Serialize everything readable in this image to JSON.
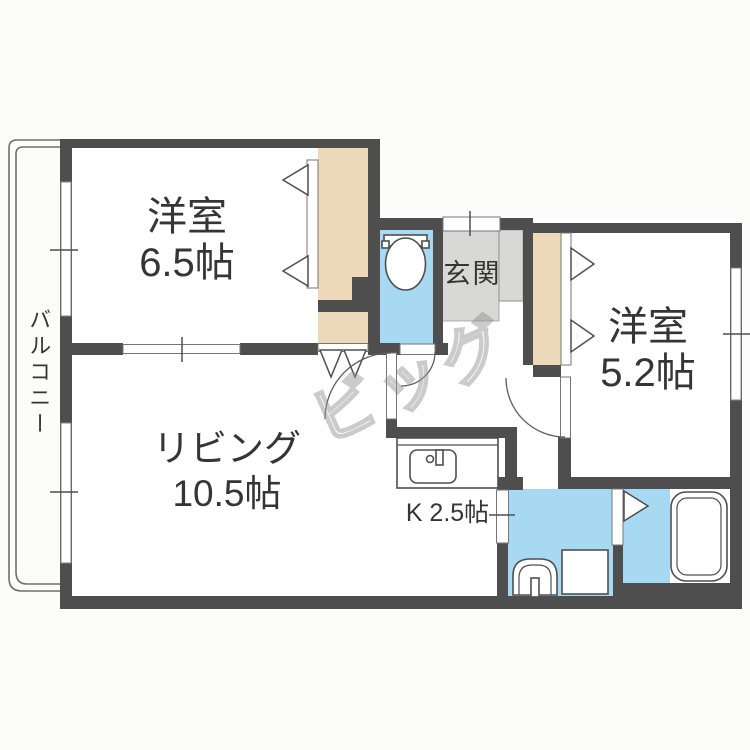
{
  "plan": {
    "balcony_label": "バルコニー",
    "entrance_label": "玄関",
    "kitchen_label": "K 2.5帖",
    "rooms": {
      "bedroom1": {
        "name": "洋室",
        "size": "6.5帖"
      },
      "bedroom2": {
        "name": "洋室",
        "size": "5.2帖"
      },
      "living": {
        "name": "リビング",
        "size": "10.5帖"
      }
    },
    "watermark": "ビッグ",
    "colors": {
      "wall": "#4e4e4e",
      "closet": "#ecd9ba",
      "water": "#a7d9f2",
      "entrance": "#d8d8d6",
      "line": "#4f4f4f"
    }
  }
}
